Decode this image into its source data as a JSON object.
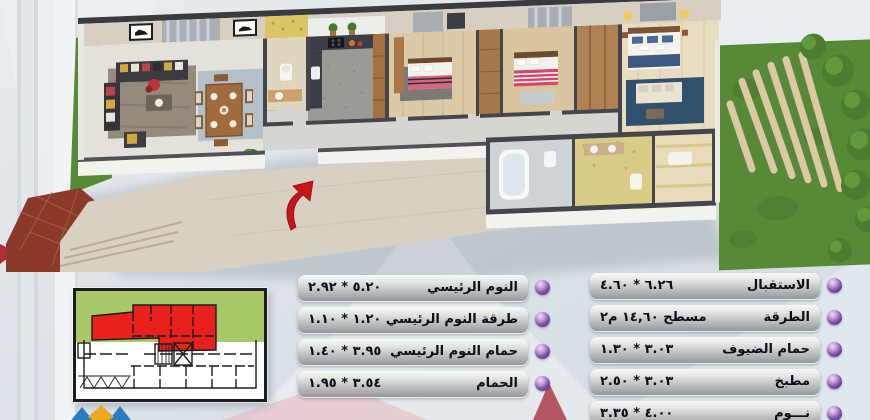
{
  "tables": {
    "master_column": {
      "rows": [
        {
          "label": "النوم الرئيسي",
          "value": "٥.٢٠ * ٢.٩٢"
        },
        {
          "label": "طرقة النوم الرئيسي",
          "value": "١.٢٠ * ١.١٠"
        },
        {
          "label": "حمام النوم الرئيسي",
          "value": "٣.٩٥ * ١.٤٠"
        },
        {
          "label": "الحمام",
          "value": "٣.٥٤ * ١.٩٥"
        }
      ]
    },
    "main_column": {
      "rows": [
        {
          "label": "الاستقبال",
          "value": "٦.٢٦ * ٤.٦٠"
        },
        {
          "label": "الطرقة",
          "value": "مسطح ١٤,٦٠ م٢"
        },
        {
          "label": "حمام الضيوف",
          "value": "٣.٠٣ * ١.٣٠"
        },
        {
          "label": "مطبخ",
          "value": "٣.٠٣ * ٢.٥٠"
        },
        {
          "label": "نـــوم",
          "value": "٤.٠٠ * ٣.٣٥"
        }
      ]
    }
  },
  "icons": {
    "row_bullet": "sphere-bullet",
    "entrance_arrow": "curved-arrow-up-right"
  },
  "colors": {
    "bullet_purple": "#7b52a8",
    "bar_text": "#0d0e16",
    "keyplan_green": "#a9c867",
    "keyplan_red": "#e8211d",
    "arrow_red": "#c4171b",
    "garden_green": "#578a36",
    "logo_blue": "#2b7bbf",
    "logo_yellow": "#eca81f"
  }
}
